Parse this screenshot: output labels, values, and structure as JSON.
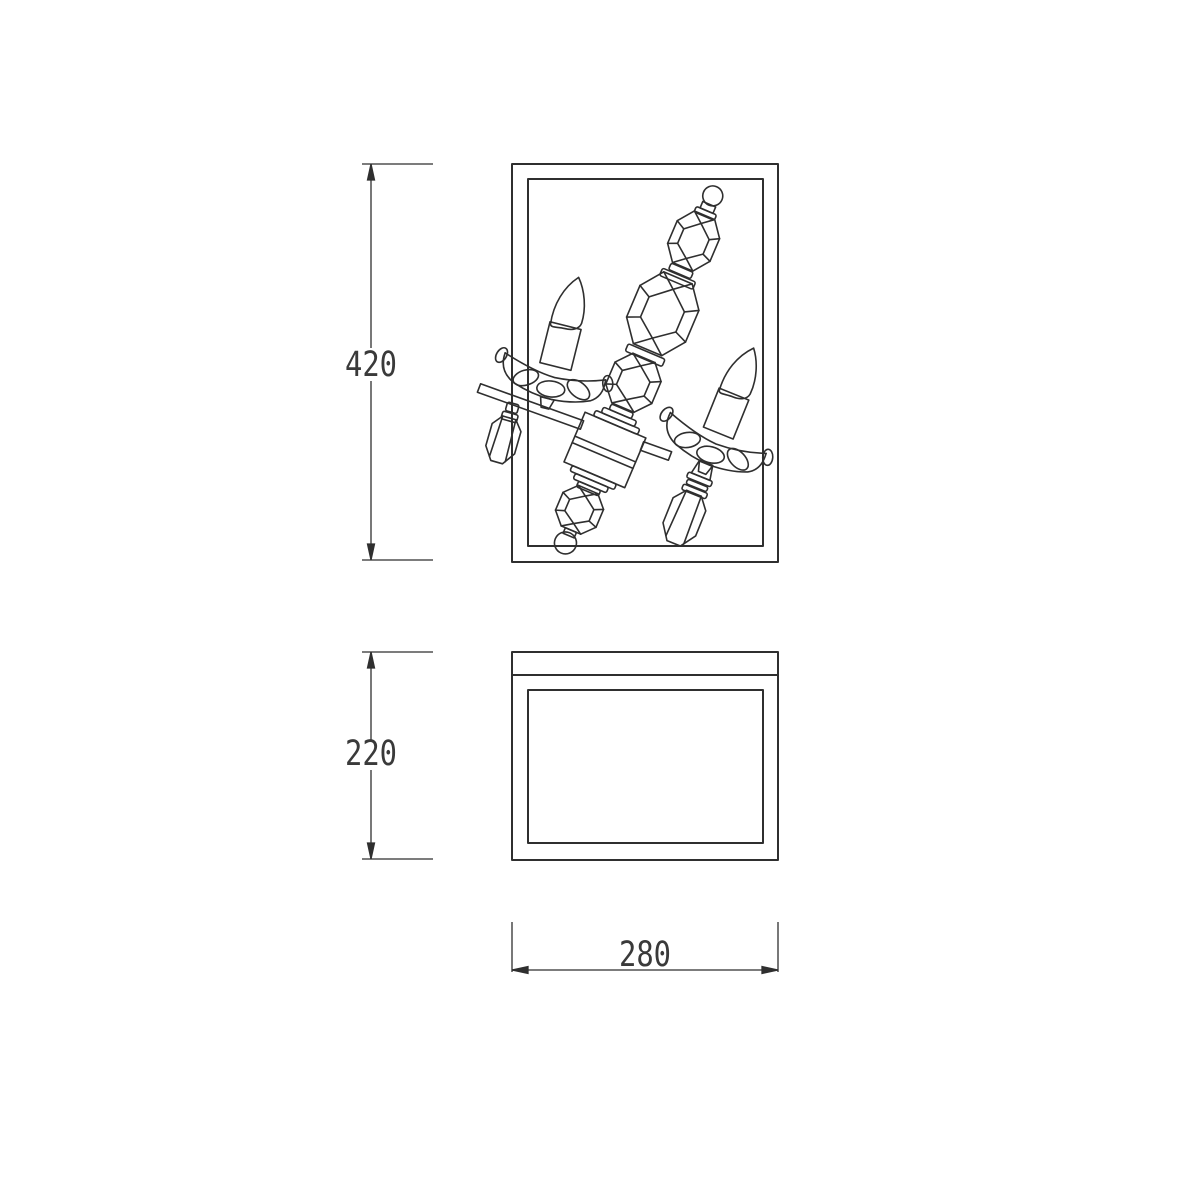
{
  "drawing": {
    "background": "#ffffff",
    "line_color": "#2f2f2f",
    "dimensions": {
      "height": {
        "value": "420"
      },
      "depth": {
        "value": "220"
      },
      "width": {
        "value": "280"
      }
    }
  }
}
